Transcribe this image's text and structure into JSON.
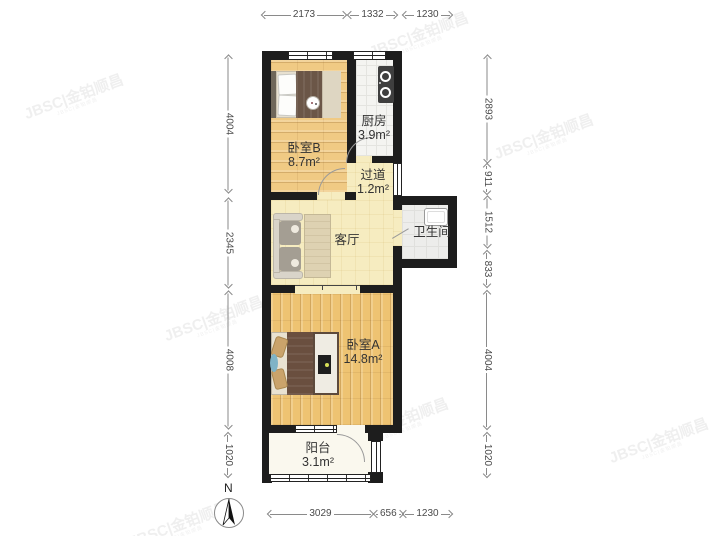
{
  "plan": {
    "rooms": {
      "bedroom_b": {
        "name": "卧室B",
        "area": "8.7m²"
      },
      "kitchen": {
        "name": "厨房",
        "area": "3.9m²"
      },
      "hallway": {
        "name": "过道",
        "area": "1.2m²"
      },
      "living_room": {
        "name": "客厅"
      },
      "bathroom": {
        "name": "卫生间"
      },
      "bedroom_a": {
        "name": "卧室A",
        "area": "14.8m²"
      },
      "balcony": {
        "name": "阳台",
        "area": "3.1m²"
      }
    },
    "dimensions_mm": {
      "top": [
        "2173",
        "1332",
        "1230"
      ],
      "bottom": [
        "3029",
        "656",
        "1230"
      ],
      "left": [
        "4004",
        "2345",
        "4008",
        "1020"
      ],
      "right": [
        "2893",
        "911",
        "1512",
        "833",
        "4004",
        "1020"
      ]
    },
    "compass": {
      "north_label": "N"
    },
    "watermark": {
      "text": "JBSC|金铂顺昌"
    },
    "colors": {
      "wall": "#1d1d1d",
      "wood_floor": "#f0ca84",
      "pale_floor": "#f6ecc0",
      "tile_floor": "#f4f4f1",
      "balcony_floor": "#faf8ee",
      "bathroom_floor": "#ededeb"
    }
  }
}
